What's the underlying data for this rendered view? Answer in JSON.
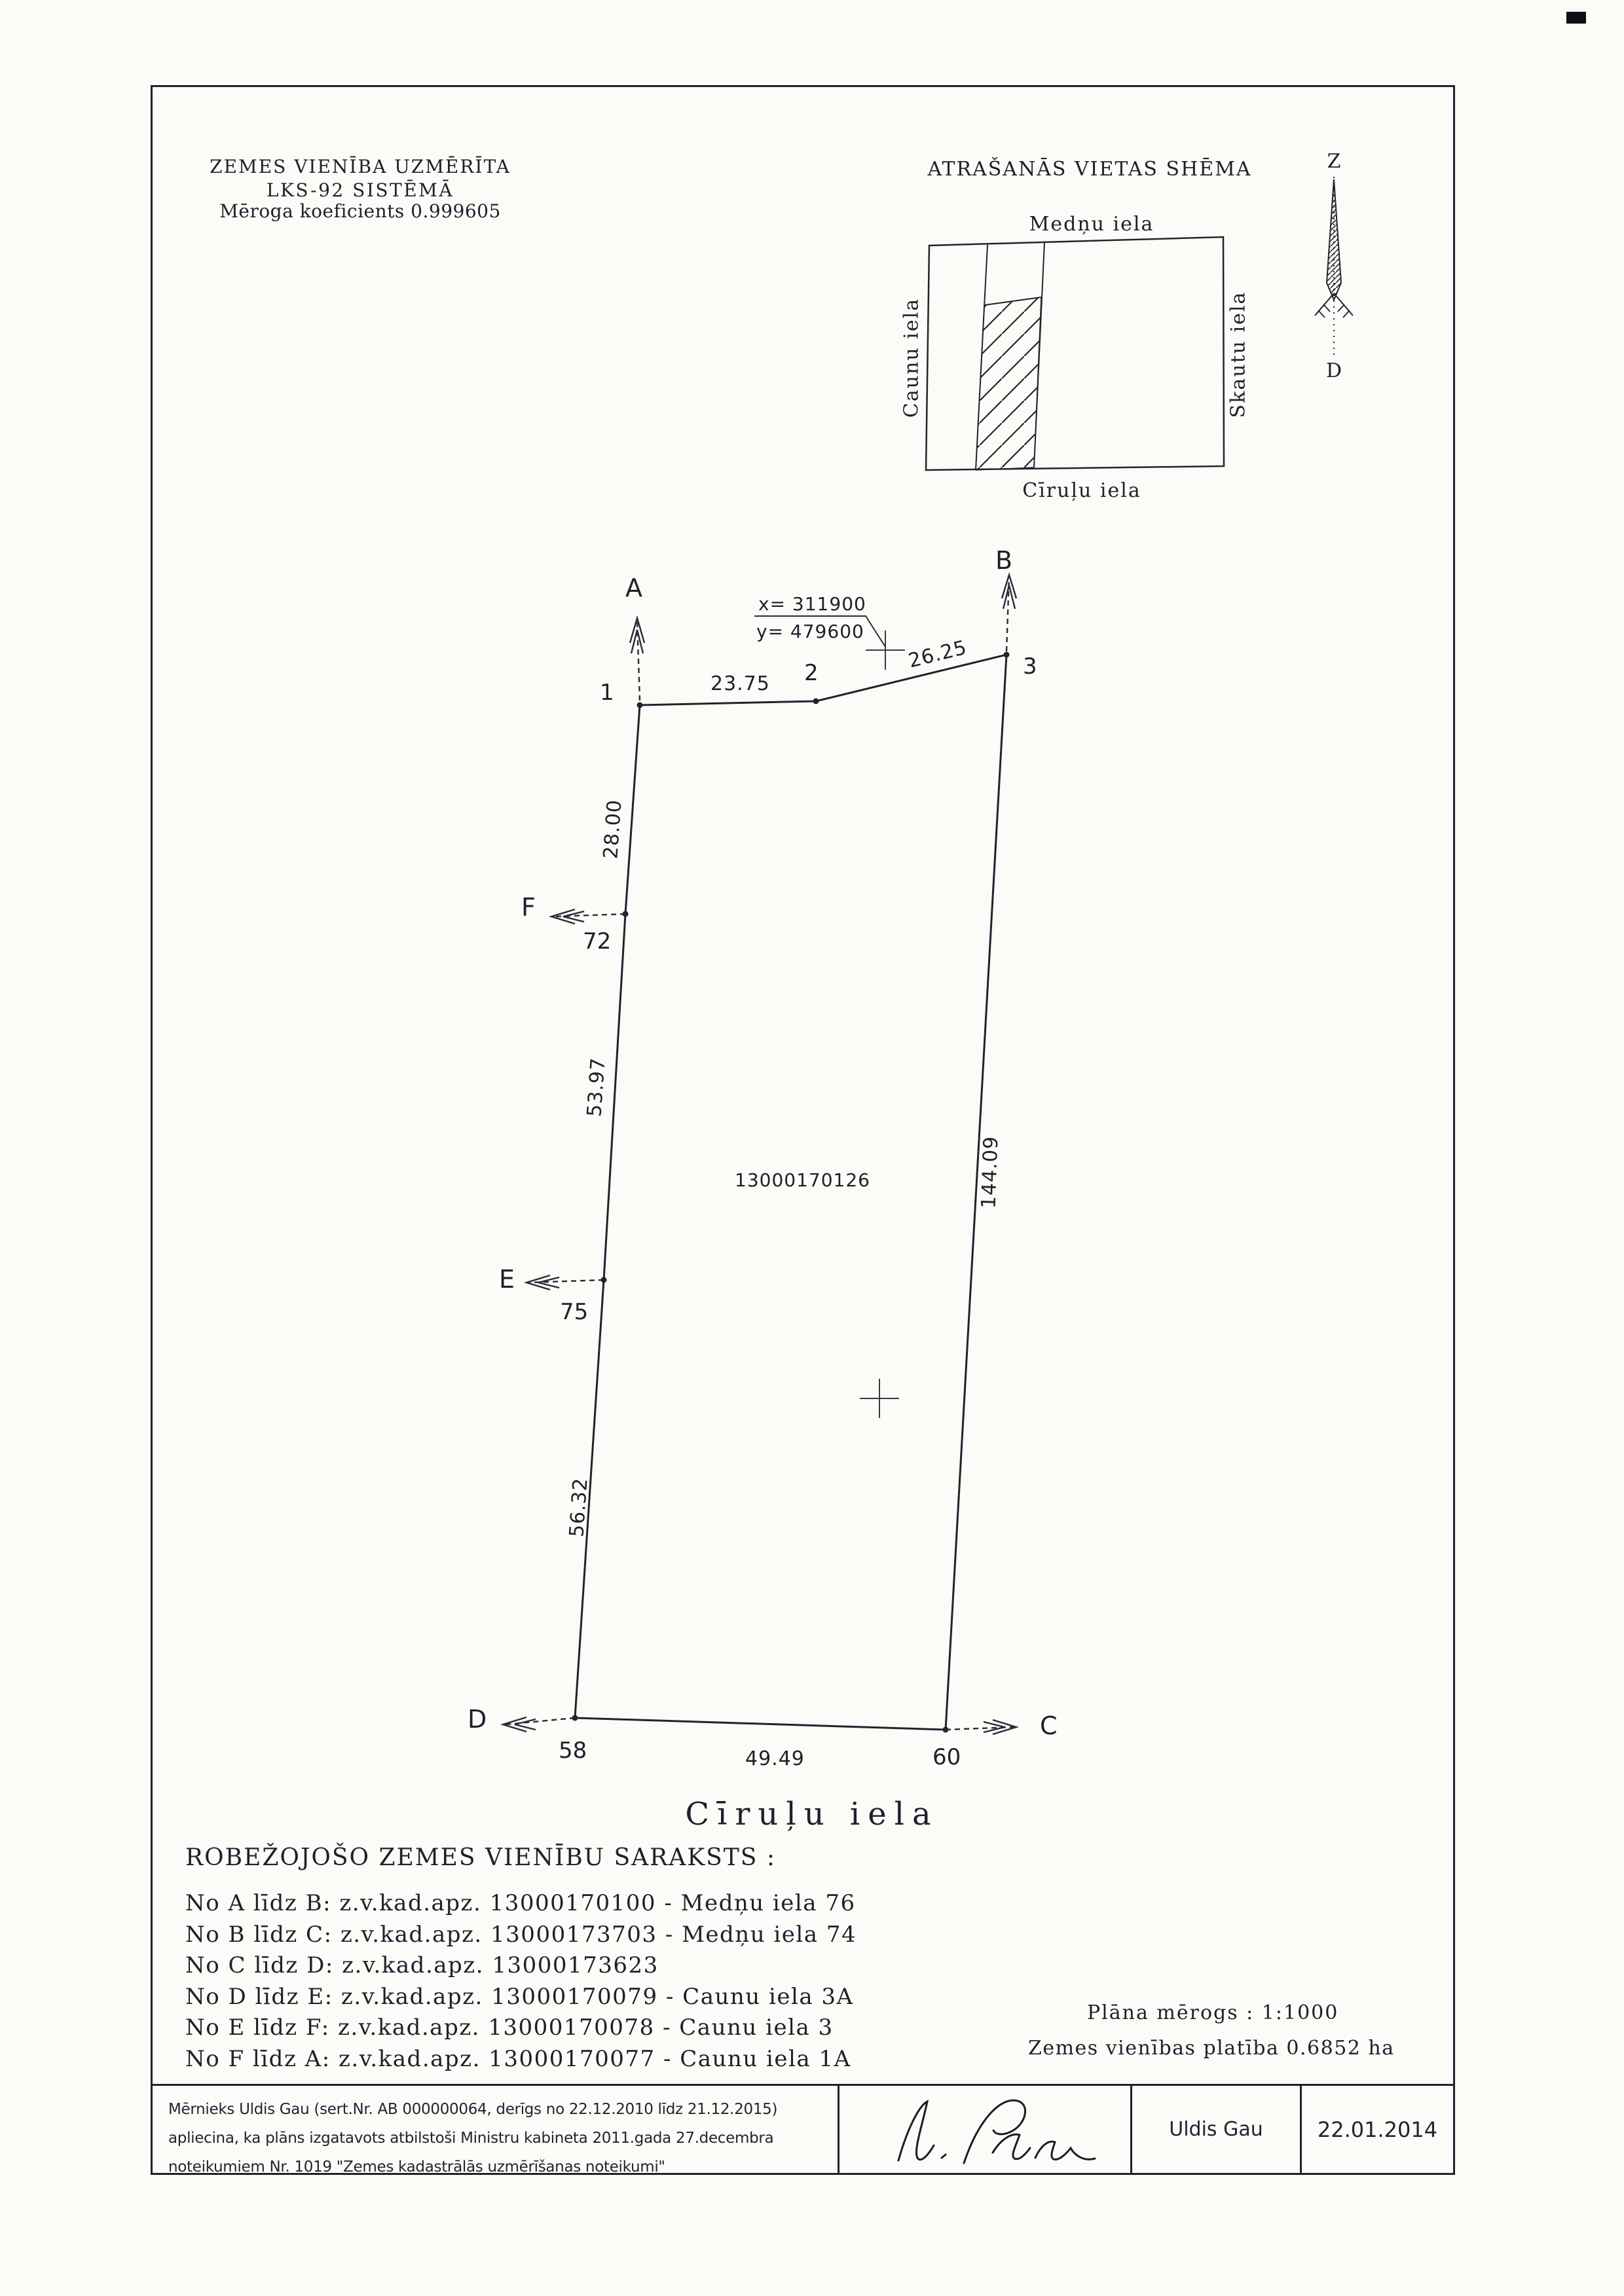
{
  "document": {
    "header": {
      "line1": "ZEMES VIENĪBA UZMĒRĪTA",
      "line2": "LKS-92 SISTĒMĀ",
      "line3": "Mēroga koeficients 0.999605"
    },
    "scheme": {
      "title": "ATRAŠANĀS VIETAS SHĒMA",
      "street_top": "Medņu iela",
      "street_left": "Caunu iela",
      "street_right": "Skautu iela",
      "street_bottom": "Cīruļu iela"
    },
    "compass": {
      "north": "Z",
      "south": "D"
    },
    "plan": {
      "parcel_number": "13000170126",
      "coord_x": "x= 311900",
      "coord_y": "y= 479600",
      "street": "Cīruļu iela",
      "points": {
        "p1": "1",
        "p2": "2",
        "p3": "3",
        "p58": "58",
        "p60": "60",
        "p72": "72",
        "p75": "75"
      },
      "directions": {
        "a": "A",
        "b": "B",
        "c": "C",
        "d": "D",
        "e": "E",
        "f": "F"
      },
      "dimensions": {
        "d_1_2": "23.75",
        "d_2_3": "26.25",
        "d_1_72": "28.00",
        "d_72_75": "53.97",
        "d_75_58": "56.32",
        "d_58_60": "49.49",
        "d_3_60": "144.09"
      }
    },
    "border_list": {
      "title": "ROBEŽOJOŠO ZEMES VIENĪBU SARAKSTS :",
      "items": [
        "No A līdz B: z.v.kad.apz. 13000170100 - Medņu iela 76",
        "No B līdz C: z.v.kad.apz. 13000173703 - Medņu iela 74",
        "No C līdz D: z.v.kad.apz. 13000173623",
        "No D līdz E: z.v.kad.apz. 13000170079 - Caunu iela 3A",
        "No E līdz F: z.v.kad.apz. 13000170078 - Caunu iela 3",
        "No F līdz A: z.v.kad.apz. 13000170077 - Caunu iela 1A"
      ]
    },
    "footer": {
      "scale": "Plāna mērogs : 1:1000",
      "area": "Zemes vienības platība 0.6852 ha"
    },
    "signature_block": {
      "cert_line1": "Mērnieks Uldis Gau (sert.Nr. AB 000000064, derīgs no 22.12.2010 līdz 21.12.2015)",
      "cert_line2": "apliecina, ka plāns izgatavots atbilstoši Ministru kabineta 2011.gada 27.decembra",
      "cert_line3": "noteikumiem Nr. 1019 \"Zemes kadastrālās uzmērīšanas noteikumi\"",
      "surveyor": "Uldis Gau",
      "date": "22.01.2014"
    }
  }
}
